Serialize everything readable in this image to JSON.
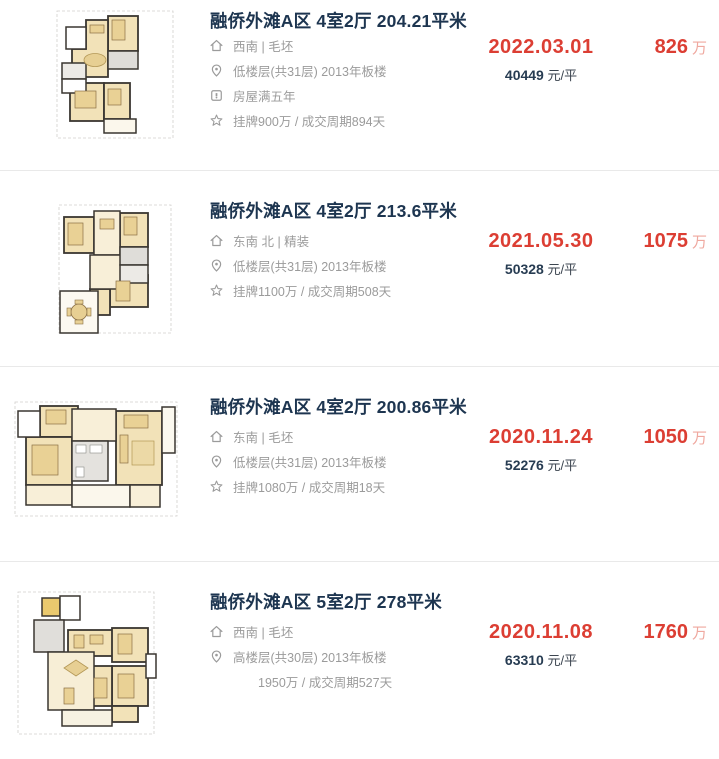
{
  "page": {
    "background": "#ffffff",
    "divider_color": "#e9e9e9"
  },
  "colors": {
    "title_navy": "#1d3550",
    "detail_gray": "#9b9b9b",
    "accent_red": "#dc3e33",
    "price_unit_pink": "#efa89f",
    "unit_price_navy": "#273c52",
    "floorplan_wall": "#3a3631",
    "floorplan_room_beige": "#f2e2b8",
    "floorplan_furniture_tan": "#e7cf93"
  },
  "listings": [
    {
      "title": "融侨外滩A区 4室2厅 204.21平米",
      "details": [
        {
          "icon": "home-icon",
          "text": "西南 | 毛坯"
        },
        {
          "icon": "location-icon",
          "text": "低楼层(共31层) 2013年板楼"
        },
        {
          "icon": "tax-badge-icon",
          "text": "房屋满五年"
        },
        {
          "icon": "star-icon",
          "text": "挂牌900万 / 成交周期894天"
        }
      ],
      "deal_date": "2022.03.01",
      "unit_price": "40449",
      "unit_price_suffix": "元/平",
      "total_price": "826",
      "price_unit": "万"
    },
    {
      "title": "融侨外滩A区 4室2厅 213.6平米",
      "details": [
        {
          "icon": "home-icon",
          "text": "东南 北 | 精装"
        },
        {
          "icon": "location-icon",
          "text": "低楼层(共31层) 2013年板楼"
        },
        {
          "icon": "star-icon",
          "text": "挂牌1100万 / 成交周期508天"
        }
      ],
      "deal_date": "2021.05.30",
      "unit_price": "50328",
      "unit_price_suffix": "元/平",
      "total_price": "1075",
      "price_unit": "万"
    },
    {
      "title": "融侨外滩A区 4室2厅 200.86平米",
      "details": [
        {
          "icon": "home-icon",
          "text": "东南 | 毛坯"
        },
        {
          "icon": "location-icon",
          "text": "低楼层(共31层) 2013年板楼"
        },
        {
          "icon": "star-icon",
          "text": "挂牌1080万 / 成交周期18天"
        }
      ],
      "deal_date": "2020.11.24",
      "unit_price": "52276",
      "unit_price_suffix": "元/平",
      "total_price": "1050",
      "price_unit": "万"
    },
    {
      "title": "融侨外滩A区 5室2厅 278平米",
      "details": [
        {
          "icon": "home-icon",
          "text": "西南 | 毛坯"
        },
        {
          "icon": "location-icon",
          "text": "高楼层(共30层) 2013年板楼"
        },
        {
          "icon": "none",
          "text": "1950万 / 成交周期527天"
        }
      ],
      "deal_date": "2020.11.08",
      "unit_price": "63310",
      "unit_price_suffix": "元/平",
      "total_price": "1760",
      "price_unit": "万"
    }
  ]
}
